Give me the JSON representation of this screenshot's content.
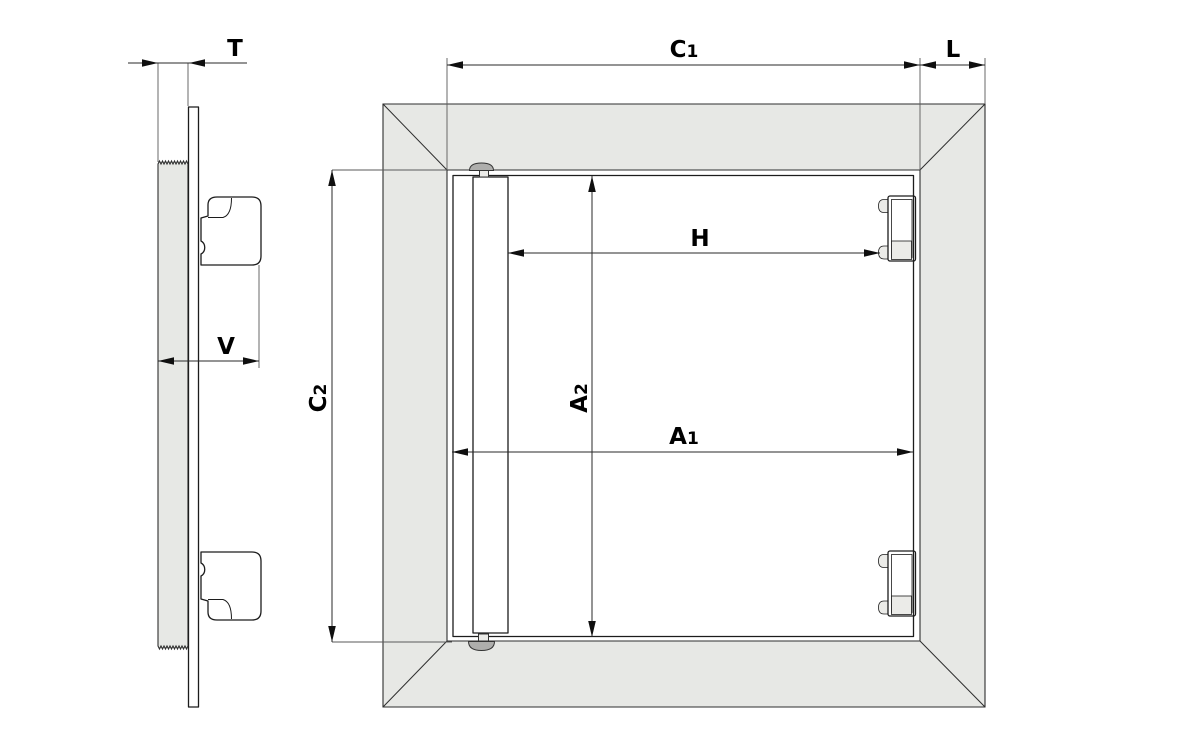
{
  "drawing": {
    "colors": {
      "background": "#ffffff",
      "frame_fill": "#e7e8e5",
      "part_fill": "#ebebe8",
      "knob_fill": "#aeaeac",
      "outline": "#1c1c1c",
      "dim_line": "#2a2a2a",
      "label": "#000000"
    },
    "side_view": {
      "dims": {
        "t": {
          "label": "T"
        },
        "v": {
          "label": "V"
        }
      }
    },
    "front_view": {
      "dims": {
        "c1": {
          "label": "C",
          "sub": "1"
        },
        "l": {
          "label": "L"
        },
        "h": {
          "label": "H"
        },
        "a1": {
          "label": "A",
          "sub": "1"
        },
        "a2": {
          "label": "A",
          "sub": "2"
        },
        "c2": {
          "label": "C",
          "sub": "2"
        }
      }
    }
  }
}
